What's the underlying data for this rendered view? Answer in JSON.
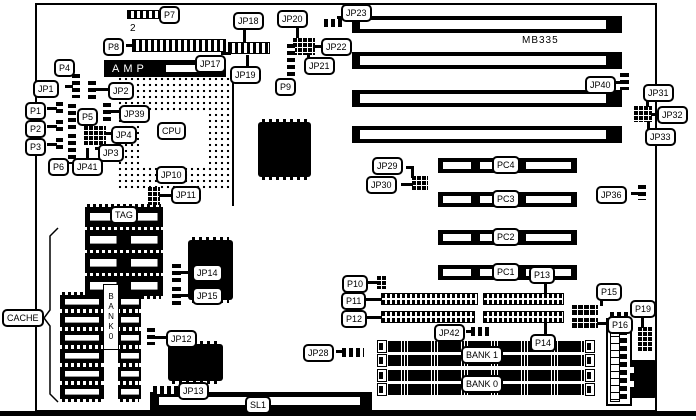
{
  "board": {
    "model": "MB335"
  },
  "colors": {
    "ink": "#000000",
    "paper": "#ffffff"
  },
  "labels": {
    "p7": "P7",
    "p8": "P8",
    "p8_pin": "2",
    "jp17": "JP17",
    "jp18": "JP18",
    "jp19": "JP19",
    "jp20": "JP20",
    "jp21": "JP21",
    "jp22": "JP22",
    "jp23": "JP23",
    "p9": "P9",
    "p4": "P4",
    "jp1": "JP1",
    "jp2": "JP2",
    "amp": "AMP",
    "cpu": "CPU",
    "jp39": "JP39",
    "p1": "P1",
    "p2": "P2",
    "p3": "P3",
    "p5": "P5",
    "p6": "P6",
    "jp4": "JP4",
    "jp3": "JP3",
    "jp41": "JP41",
    "jp10": "JP10",
    "jp11": "JP11",
    "tag": "TAG",
    "cache": "CACHE",
    "bank0_chips": "BANK0",
    "jp14": "JP14",
    "jp15": "JP15",
    "jp12": "JP12",
    "jp13": "JP13",
    "jp28": "JP28",
    "jp29": "JP29",
    "jp30": "JP30",
    "jp36": "JP36",
    "jp40": "JP40",
    "jp31": "JP31",
    "jp32": "JP32",
    "jp33": "JP33",
    "pc1": "PC1",
    "pc2": "PC2",
    "pc3": "PC3",
    "pc4": "PC4",
    "p10": "P10",
    "p11": "P11",
    "p12": "P12",
    "p13": "P13",
    "p14": "P14",
    "p15": "P15",
    "p16": "P16",
    "p19": "P19",
    "jp42": "JP42",
    "bank1_simm": "BANK 1",
    "bank0_simm": "BANK 0",
    "sl1": "SL1"
  }
}
